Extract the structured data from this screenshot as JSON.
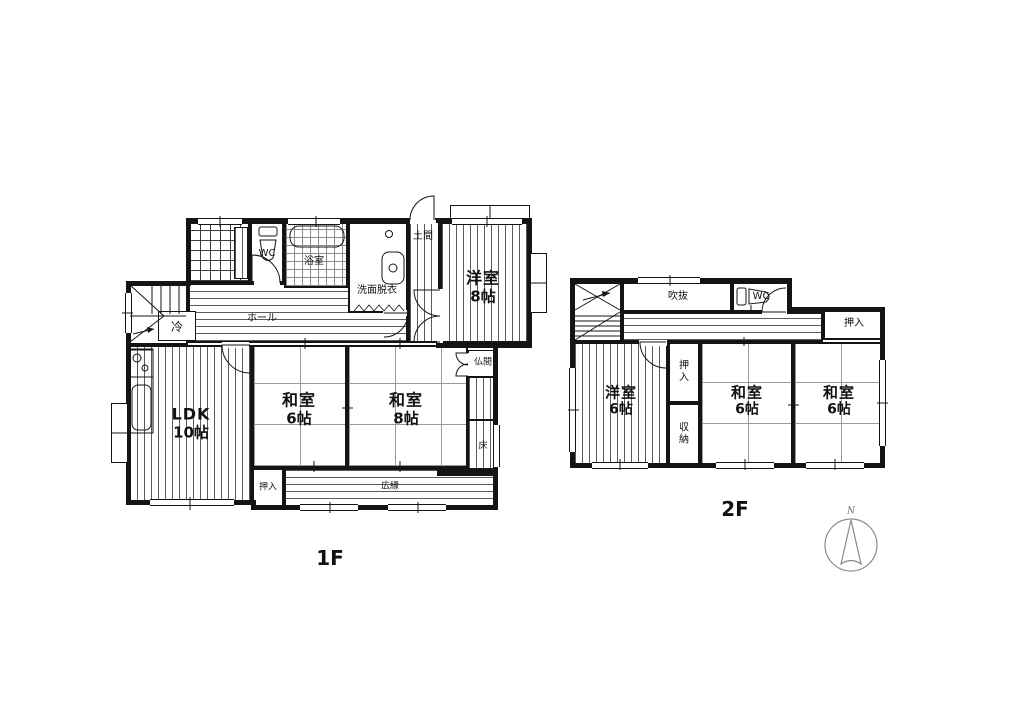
{
  "floor1": {
    "title": "1F",
    "rooms": {
      "wc": "WC",
      "bath": "浴室",
      "washroom": "洗面脱衣",
      "doma": "土間",
      "western8": {
        "name": "洋室",
        "size": "8帖"
      },
      "hall": "ホール",
      "fridge": "冷",
      "ldk": {
        "name": "LDK",
        "size": "10帖"
      },
      "washitsu6": {
        "name": "和室",
        "size": "6帖"
      },
      "washitsu8": {
        "name": "和室",
        "size": "8帖"
      },
      "butsuma": "仏間",
      "tokonoma": "床",
      "oshiire": "押入",
      "hiroen": "広縁"
    }
  },
  "floor2": {
    "title": "2F",
    "rooms": {
      "fukinuke": "吹抜",
      "wc": "WC",
      "oshiire_top": "押入",
      "western6": {
        "name": "洋室",
        "size": "6帖"
      },
      "oshiire": "押入",
      "shuno": "収納",
      "washitsu6_center": {
        "name": "和室",
        "size": "6帖"
      },
      "washitsu6_right": {
        "name": "和室",
        "size": "6帖"
      }
    }
  },
  "compass": {
    "label": "N"
  }
}
